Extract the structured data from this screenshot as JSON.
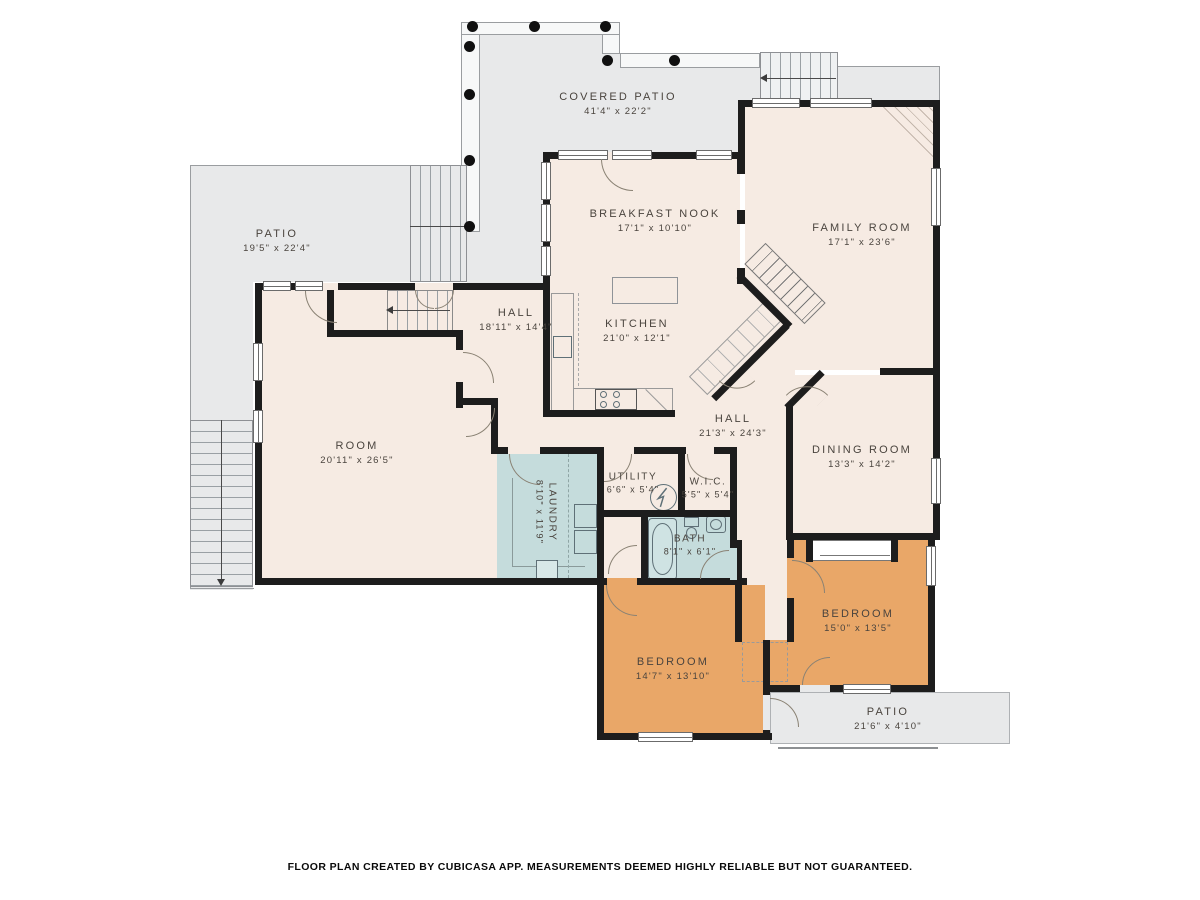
{
  "footer": "FLOOR PLAN CREATED BY CUBICASA APP. MEASUREMENTS DEEMED HIGHLY RELIABLE BUT NOT GUARANTEED.",
  "colors": {
    "room_fill": "#f6ebe3",
    "bedroom_fill": "#e9a768",
    "wet_room_fill": "#c5dcdc",
    "patio_fill": "#e8e9ea",
    "wall": "#1d1d1d"
  },
  "rooms": {
    "covered_patio": {
      "name": "COVERED PATIO",
      "dims": "41'4\" x 22'2\""
    },
    "patio_left": {
      "name": "PATIO",
      "dims": "19'5\" x 22'4\""
    },
    "breakfast_nook": {
      "name": "BREAKFAST NOOK",
      "dims": "17'1\" x 10'10\""
    },
    "family_room": {
      "name": "FAMILY ROOM",
      "dims": "17'1\" x 23'6\""
    },
    "hall_upper": {
      "name": "HALL",
      "dims": "18'11\" x 14'4\""
    },
    "kitchen": {
      "name": "KITCHEN",
      "dims": "21'0\" x 12'1\""
    },
    "room": {
      "name": "ROOM",
      "dims": "20'11\" x 26'5\""
    },
    "hall_lower": {
      "name": "HALL",
      "dims": "21'3\" x 24'3\""
    },
    "dining_room": {
      "name": "DINING ROOM",
      "dims": "13'3\" x 14'2\""
    },
    "laundry": {
      "name": "LAUNDRY",
      "dims": "8'10\" x 11'9\""
    },
    "utility": {
      "name": "UTILITY",
      "dims": "6'6\" x 5'4\""
    },
    "wic": {
      "name": "W.I.C.",
      "dims": "5'5\" x 5'4\""
    },
    "bath": {
      "name": "BATH",
      "dims": "8'1\" x 6'1\""
    },
    "bedroom_left": {
      "name": "BEDROOM",
      "dims": "14'7\" x 13'10\""
    },
    "bedroom_right": {
      "name": "BEDROOM",
      "dims": "15'0\" x 13'5\""
    },
    "patio_bottom": {
      "name": "PATIO",
      "dims": "21'6\" x 4'10\""
    }
  }
}
